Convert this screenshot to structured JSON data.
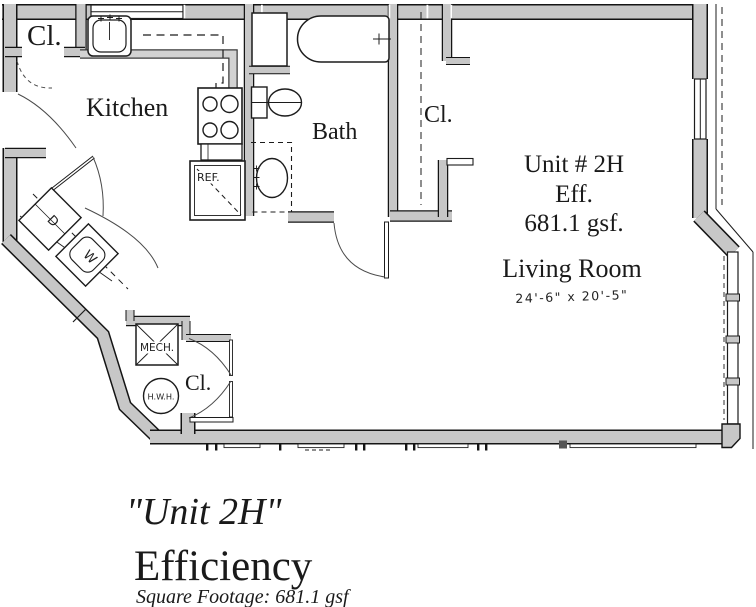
{
  "plan": {
    "labels": {
      "closet_top_left": "Cl.",
      "kitchen": "Kitchen",
      "bath": "Bath",
      "closet_right": "Cl.",
      "unit_line1": "Unit # 2H",
      "unit_line2": "Eff.",
      "unit_line3": "681.1 gsf.",
      "living_room": "Living Room",
      "living_room_dims": "24'-6\" x 20'-5\"",
      "refrigerator": "REF.",
      "dryer": "D",
      "washer": "W",
      "mechanical": "MECH.",
      "water_heater": "H.W.H.",
      "closet_bottom": "Cl."
    }
  },
  "caption": {
    "title": "\"Unit 2H\"",
    "subtitle": "Efficiency",
    "footnote": "Square Footage:  681.1 gsf"
  },
  "colors": {
    "wall_fill": "#c7c7c7",
    "line": "#141414",
    "thin_line": "#4a4a4a",
    "background": "#ffffff"
  }
}
